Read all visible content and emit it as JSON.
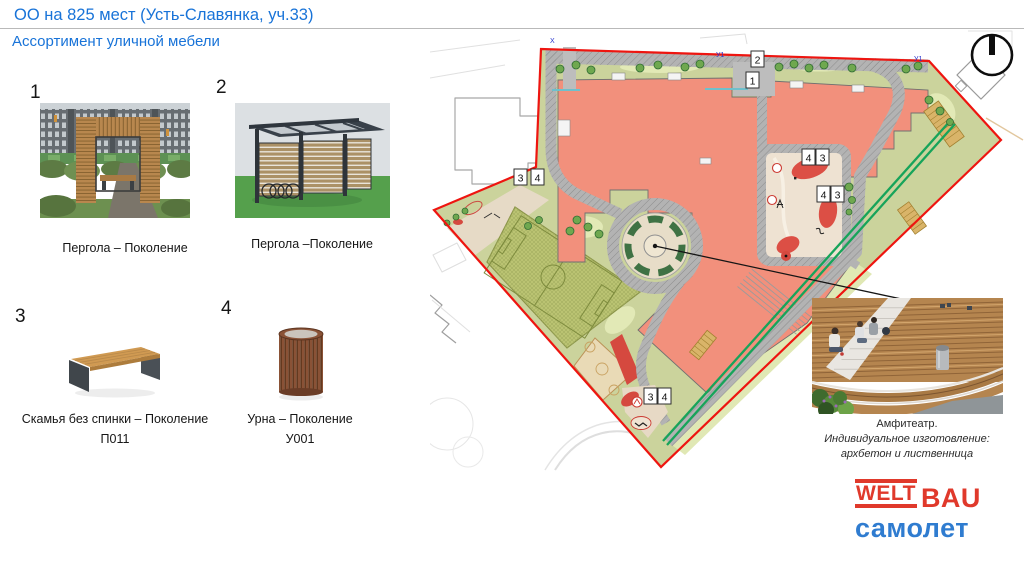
{
  "header": {
    "title": "ОО на 825 мест (Усть-Славянка, уч.33)",
    "subtitle": "Ассортимент уличной мебели"
  },
  "items": [
    {
      "num": "1",
      "caption": "Пергола – Поколение",
      "code": ""
    },
    {
      "num": "2",
      "caption": "Пергола –Поколение",
      "code": ""
    },
    {
      "num": "3",
      "caption": "Скамья без спинки – Поколение",
      "code": "П011"
    },
    {
      "num": "4",
      "caption": "Урна – Поколение",
      "code": "У001"
    }
  ],
  "map": {
    "markers": [
      {
        "label": "2",
        "x": 751,
        "y": 51
      },
      {
        "label": "1",
        "x": 746,
        "y": 72
      },
      {
        "label": "4",
        "x": 802,
        "y": 149
      },
      {
        "label": "3",
        "x": 816,
        "y": 149
      },
      {
        "label": "4",
        "x": 817,
        "y": 186
      },
      {
        "label": "3",
        "x": 831,
        "y": 186
      },
      {
        "label": "3",
        "x": 514,
        "y": 169
      },
      {
        "label": "4",
        "x": 531,
        "y": 169
      },
      {
        "label": "3",
        "x": 644,
        "y": 388
      },
      {
        "label": "4",
        "x": 658,
        "y": 388
      }
    ],
    "blue_labels": [
      {
        "text": "У1",
        "x": 716,
        "y": 57
      },
      {
        "text": "У1",
        "x": 914,
        "y": 61
      },
      {
        "text": "X",
        "x": 550,
        "y": 43
      }
    ],
    "colors": {
      "site_boundary": "#ee1510",
      "building": "#f2907c",
      "roads": "#b3b3b3",
      "greenery": "#cbd39c",
      "sport_field": "#bcc573",
      "green_corridor": "#17a45a",
      "playground": "#d5493f"
    }
  },
  "amphitheater": {
    "line1": "Амфитеатр.",
    "line2": "Индивидуальное изготовление:",
    "line3": "архбетон и лиственница"
  },
  "logo": {
    "welt": "WELT",
    "bau": "BAU",
    "brand": "самолет",
    "red": "#e0392b",
    "blue": "#2f7cd0"
  }
}
